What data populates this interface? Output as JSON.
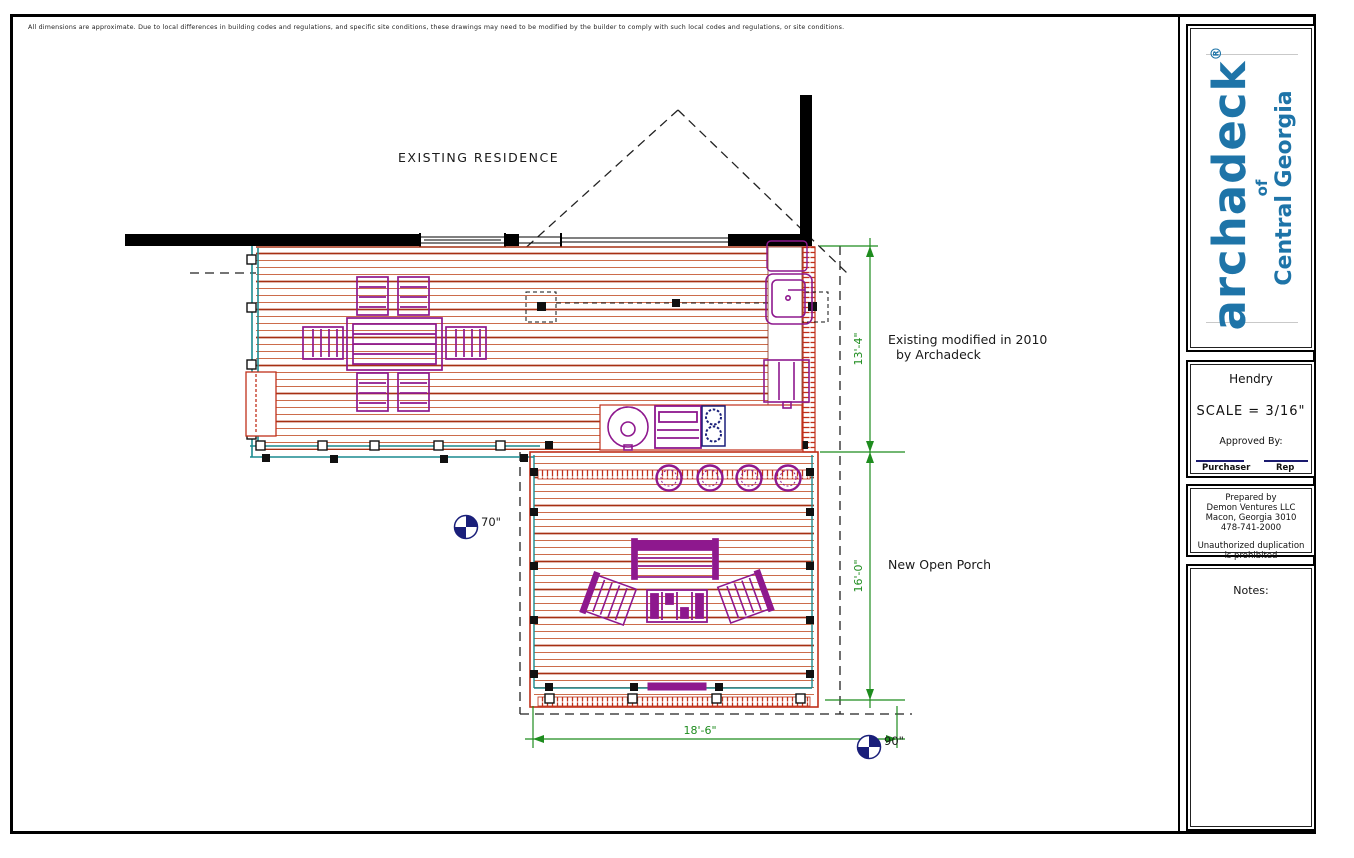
{
  "page": {
    "disclaimer": "All dimensions are approximate. Due to local differences in building codes and regulations, and specific site conditions, these drawings may need to be modified by the builder to comply with such local codes and regulations, or site conditions."
  },
  "plan": {
    "labels": {
      "existing_residence": "EXISTING RESIDENCE",
      "existing_modified_line1": "Existing modified in 2010",
      "existing_modified_line2": "by Archadeck",
      "new_open_porch": "New Open Porch",
      "height_marker_left": "70\"",
      "height_marker_right": "90\""
    },
    "dimensions": {
      "existing_deck_depth": "13'-4\"",
      "porch_depth": "16'-0\"",
      "porch_width": "18'-6\""
    },
    "colors": {
      "deck_board_dark": "#a63014",
      "deck_board_light": "#c75b36",
      "railing_teal": "#1a8a8f",
      "furniture_purple": "#8e188e",
      "dimension_green": "#1e8c1e",
      "marker_navy": "#1a1f7a",
      "wall_black": "#000000"
    }
  },
  "title_block": {
    "logo": {
      "brand": "archadeck",
      "registered": "®",
      "of": "of",
      "region": "Central Georgia",
      "color": "#1e74a8"
    },
    "project": {
      "client": "Hendry",
      "scale": "SCALE = 3/16\"",
      "approved_by": "Approved By:",
      "purchaser_label": "Purchaser",
      "rep_label": "Rep"
    },
    "prepared": {
      "line1": "Prepared by",
      "line2": "Demon Ventures LLC",
      "line3": "Macon, Georgia 3010",
      "line4": "478-741-2000",
      "line5": "Unauthorized duplication",
      "line6": "is prohibited"
    },
    "notes": {
      "heading": "Notes:"
    }
  }
}
